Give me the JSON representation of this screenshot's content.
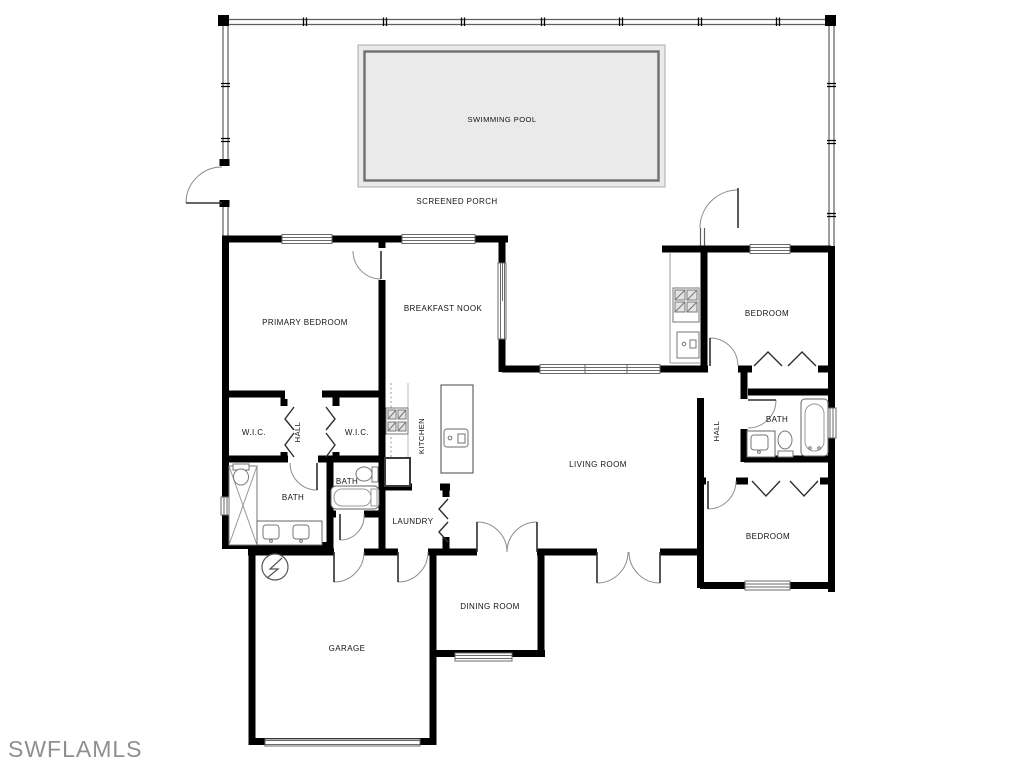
{
  "plan": {
    "colors": {
      "wall": "#000000",
      "pool_fill": "#eaeaea",
      "screen_line": "#666666",
      "fixture_line": "#777777",
      "label_text": "#141414",
      "watermark_text": "#8f8f8f"
    },
    "areas": {
      "pool": {
        "label": "SWIMMING POOL"
      },
      "porch": {
        "label": "SCREENED PORCH"
      }
    },
    "rooms": [
      {
        "id": "primary-bedroom",
        "label": "PRIMARY BEDROOM"
      },
      {
        "id": "breakfast-nook",
        "label": "BREAKFAST NOOK"
      },
      {
        "id": "bedroom-northeast",
        "label": "BEDROOM"
      },
      {
        "id": "wic-left",
        "label": "W.I.C."
      },
      {
        "id": "hall-primary",
        "label": "HALL"
      },
      {
        "id": "wic-right",
        "label": "W.I.C."
      },
      {
        "id": "kitchen",
        "label": "KITCHEN"
      },
      {
        "id": "bath-primary",
        "label": "BATH"
      },
      {
        "id": "bath-pool",
        "label": "BATH"
      },
      {
        "id": "laundry",
        "label": "LAUNDRY"
      },
      {
        "id": "living-room",
        "label": "LIVING ROOM"
      },
      {
        "id": "hall-bedrooms",
        "label": "HALL"
      },
      {
        "id": "bath-guest",
        "label": "BATH"
      },
      {
        "id": "bedroom-southeast",
        "label": "BEDROOM"
      },
      {
        "id": "dining-room",
        "label": "DINING ROOM"
      },
      {
        "id": "garage",
        "label": "GARAGE"
      }
    ],
    "symbols": {
      "shower": "x-hatched-rectangle",
      "bathtub": "rounded-rectangle-with-oval",
      "toilet": "tank-and-bowl-ellipse",
      "sink": "rect-with-faucet-dot",
      "range": "hatched-four-burner-square",
      "grill": "hatched-four-burner-square",
      "water-heater": "circle-with-zigzag",
      "door": "quarter-arc-swing",
      "bifold-door": "chevron-pair",
      "window": "double-parallel-lines",
      "screen-wall": "thin-double-line-with-posts"
    }
  },
  "watermark": {
    "text": "SWFLAMLS"
  }
}
